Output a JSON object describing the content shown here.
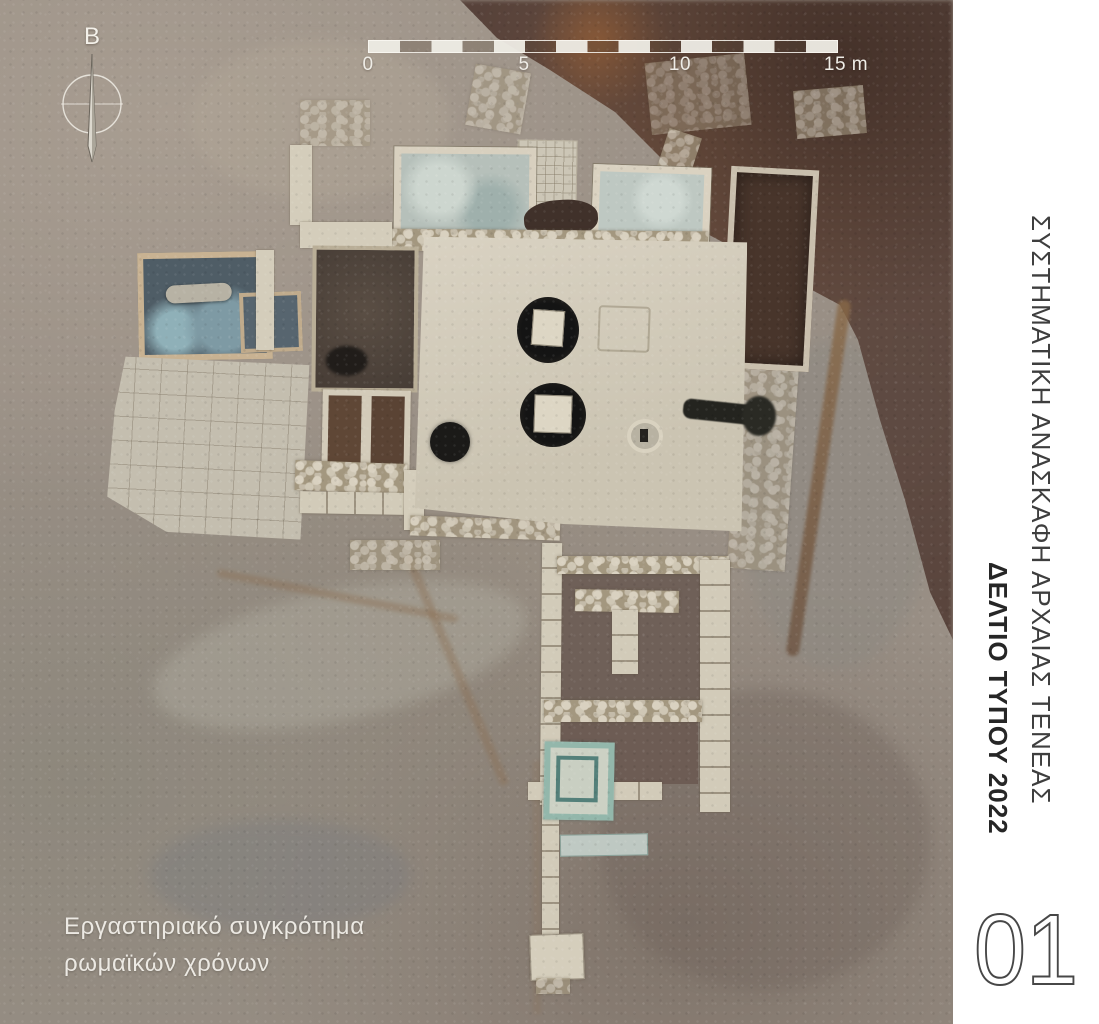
{
  "figure": {
    "north_label": "B",
    "scale_bar": {
      "tick_labels": [
        "0",
        "5",
        "10",
        "15 m"
      ],
      "total_meters": 15,
      "segments": 15
    },
    "caption": {
      "line1": "Εργαστηριακό συγκρότημα",
      "line2": "ρωμαϊκών χρόνων"
    }
  },
  "sidebar": {
    "series_title": "ΣΥΣΤΗΜΑΤΙΚΗ ΑΝΑΣΚΑΦΗ ΑΡΧΑΙΑΣ ΤΕΝΕΑΣ",
    "document_title": "ΔΕΛΤΙΟ ΤΥΠΟΥ 2022",
    "page_number": "01"
  },
  "colors": {
    "sidebar_bg": "#ffffff",
    "sidebar_text": "#3e3e3e",
    "sidebar_text_bold": "#262626",
    "annotation_text": "#efede7",
    "soil_gray": "#998f85",
    "soil_red_brown": "#57423a",
    "plaster_white": "#d6cfbf",
    "hydraulic_turquoise": "#93b7ab",
    "pool_blue_gray": "#4f5d66",
    "vat_dark": "#141414"
  }
}
